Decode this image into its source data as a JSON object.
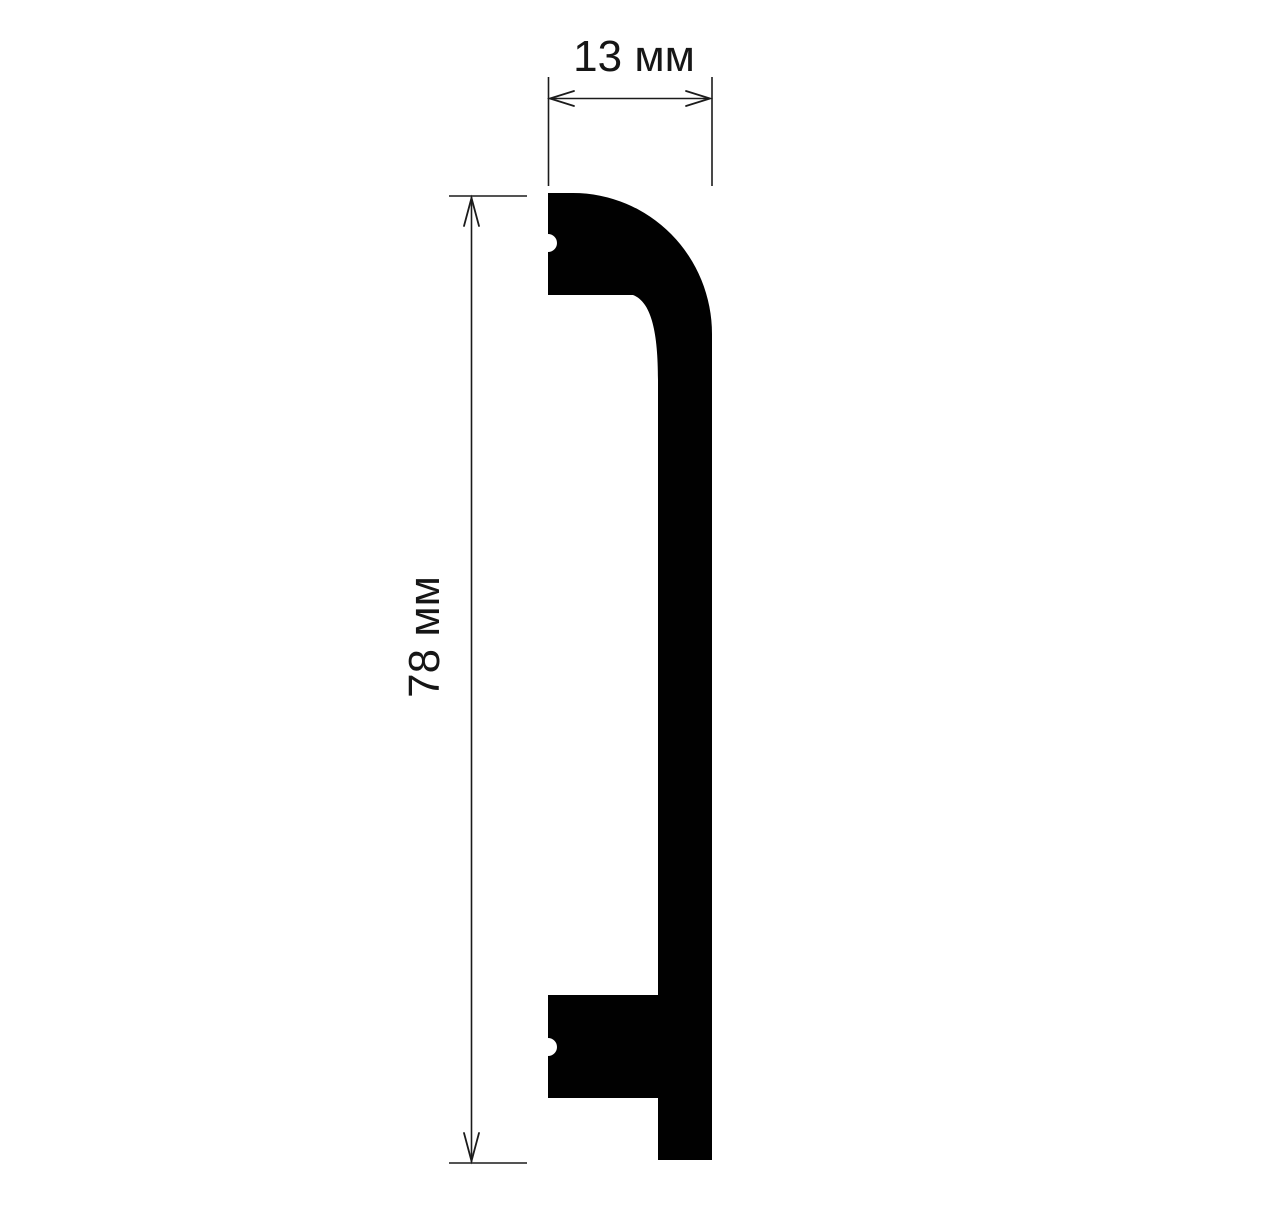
{
  "diagram": {
    "width_dimension": {
      "label": "13 мм",
      "value": 13,
      "unit": "мм"
    },
    "height_dimension": {
      "label": "78 мм",
      "value": 78,
      "unit": "мм"
    },
    "colors": {
      "background": "#ffffff",
      "shape": "#010101",
      "line": "#1b1b1b",
      "text": "#161616"
    }
  }
}
